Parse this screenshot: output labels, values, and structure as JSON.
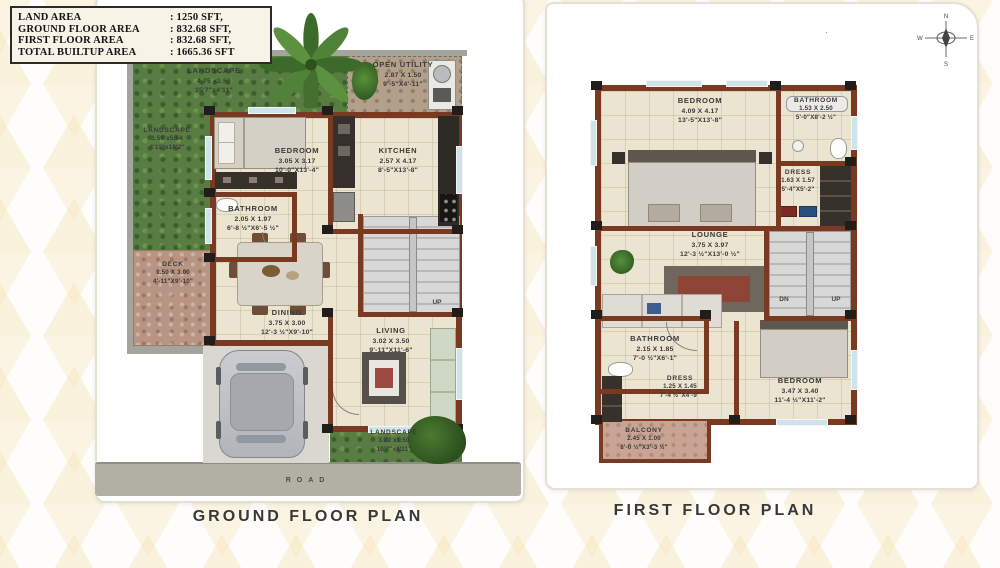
{
  "legend": {
    "rows": [
      {
        "label": "LAND AREA",
        "value": ": 1250 SFT,"
      },
      {
        "label": "GROUND FLOOR AREA",
        "value": ":   832.68 SFT,"
      },
      {
        "label": "FIRST FLOOR AREA",
        "value": ":   832.68 SFT,"
      },
      {
        "label": "TOTAL BUILTUP AREA",
        "value": ": 1665.36 SFT"
      }
    ]
  },
  "compass": {
    "n": "N",
    "e": "E",
    "s": "S",
    "w": "W"
  },
  "colors": {
    "wall": "#7a3a21",
    "grass": "#587d42",
    "floor": "#ebe4d1",
    "deck": "#b89483",
    "road": "#b2afa5",
    "pattern": "#f6e3b8"
  },
  "ground": {
    "title": "GROUND FLOOR PLAN",
    "road": "ROAD",
    "up": "UP",
    "rooms": {
      "landscape_top": {
        "name": "LANDSCAPE",
        "metric": "4.75 x1.50",
        "imperial": "15'7\"x4'11\""
      },
      "landscape_left": {
        "name": "LANDSCAPE",
        "metric": "1.50 x5.54",
        "imperial": "4'11\"x18'2\""
      },
      "open_utility": {
        "name": "OPEN UTILITY",
        "metric": "2.87 X 1.50",
        "imperial": "9'-5\"X4'-11\""
      },
      "bedroom": {
        "name": "BEDROOM",
        "metric": "3.05 X 3.17",
        "imperial": "10'-0\"X13'-4\""
      },
      "kitchen": {
        "name": "KITCHEN",
        "metric": "2.57 X 4.17",
        "imperial": "8'-5\"X13'-8\""
      },
      "bathroom": {
        "name": "BATHROOM",
        "metric": "2.05 X 1.97",
        "imperial": "6'-8 ½\"X6'-5 ½\""
      },
      "deck": {
        "name": "DECK",
        "metric": "1.50 X 3.00",
        "imperial": "4'-11\"X9'-10\""
      },
      "dining": {
        "name": "DINING",
        "metric": "3.75 X 3.00",
        "imperial": "12'-3 ½\"X9'-10\""
      },
      "living": {
        "name": "LIVING",
        "metric": "3.02 X 3.50",
        "imperial": "9'-11\"X11'-6\""
      },
      "landscape_bottom": {
        "name": "LANDSCAPE",
        "metric": "3.22 x1.50",
        "imperial": "10'7\"x4'11\""
      }
    }
  },
  "first": {
    "title": "FIRST FLOOR PLAN",
    "dn": "DN",
    "up": "UP",
    "rooms": {
      "bedroom1": {
        "name": "BEDROOM",
        "metric": "4.09 X 4.17",
        "imperial": "13'-5\"X13'-8\""
      },
      "bathroom1": {
        "name": "BATHROOM",
        "metric": "1.53 X 2.50",
        "imperial": "5'-0\"X8'-2 ½\""
      },
      "dress1": {
        "name": "DRESS",
        "metric": "1.63 X 1.57",
        "imperial": "5'-4\"X5'-2\""
      },
      "lounge": {
        "name": "LOUNGE",
        "metric": "3.75 X 3.97",
        "imperial": "12'-3 ½\"X13'-0 ½\""
      },
      "bathroom2": {
        "name": "BATHROOM",
        "metric": "2.15 X 1.85",
        "imperial": "7'-0 ½\"X6'-1\""
      },
      "dress2": {
        "name": "DRESS",
        "metric": "1.25 X 1.45",
        "imperial": "7'-4 ½\"X4'-9\""
      },
      "bedroom2": {
        "name": "BEDROOM",
        "metric": "3.47 X 3.40",
        "imperial": "11'-4 ½\"X11'-2\""
      },
      "balcony": {
        "name": "BALCONY",
        "metric": "2.45 X 1.00",
        "imperial": "8'-0 ½\"X3'-3 ½\""
      }
    }
  }
}
